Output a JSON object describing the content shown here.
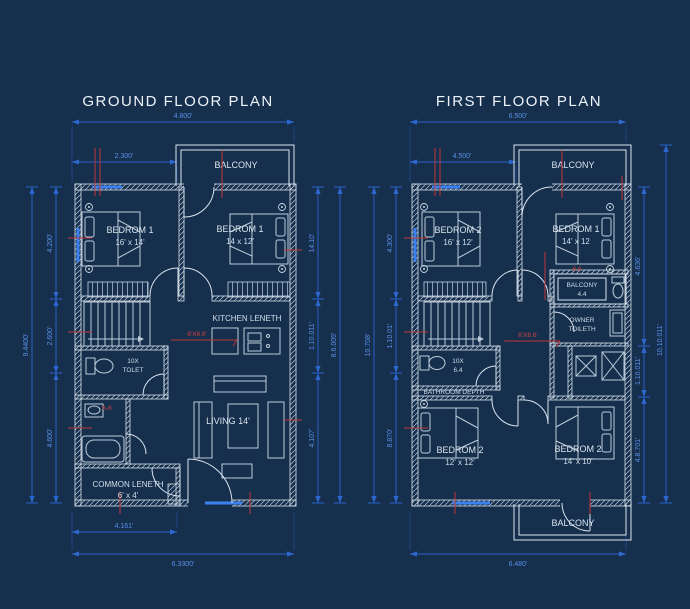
{
  "colors": {
    "background": "#152f4d",
    "wall_line": "#d8e1eb",
    "dimension_blue": "#2d66cf",
    "dimension_text_blue": "#5b8fe8",
    "window_blue": "#3b82f0",
    "annotation_red": "#c03636",
    "label_white": "#dbe5ef"
  },
  "icons": [
    "stairs-icon",
    "bed-icon",
    "wardrobe-icon",
    "kitchen-counter-icon",
    "sink-icon",
    "toilet-icon",
    "bathtub-icon",
    "washbasin-icon",
    "sofa-icon",
    "table-icon",
    "tv-unit-icon",
    "door-arc-icon",
    "window-marker-icon",
    "ceiling-point-icon",
    "shower-icon"
  ],
  "ground": {
    "title": "GROUND FLOOR PLAN",
    "dims": {
      "top_overall": "4.800'",
      "top_left": "2.300'",
      "bottom_left": "4.161'",
      "bottom_overall": "6.3300'",
      "left_seg1": "4.200'",
      "left_seg2": "2.600'",
      "left_seg3": "4.600'",
      "left_overall": "9.4400'",
      "right_seg1": "14.10'",
      "right_seg2": "1.10.011'",
      "right_seg3": "4.107'",
      "right_overall": "8.6.005'"
    },
    "labels": {
      "balcony": "BALCONY",
      "bed_tl_name": "BEDROM 1",
      "bed_tl_size": "16' x 14'",
      "bed_tr_name": "BEDROM 1",
      "bed_tr_size": "14 x 12'",
      "kitchen": "KITCHEN LENETH",
      "toilet_l1": "10X",
      "toilet_l2": "TOLET",
      "living": "LIVING 14'",
      "common_l1": "COMMON LENETH",
      "common_l2": "6' x 4'",
      "red_kitchen": "6'X6.6'",
      "red_toilet": "6-6"
    }
  },
  "first": {
    "title": "FIRST FLOOR PLAN",
    "dims": {
      "top_overall": "6.500'",
      "top_left": "4.500'",
      "bottom_overall": "6.480'",
      "left_seg1": "4.300'",
      "left_seg2": "1.10.01'",
      "left_seg3": "8.870'",
      "left_overall": "10.708'",
      "right_seg1": "4.636'",
      "right_seg2": "1.10.011'",
      "right_seg3": "4.8.701'",
      "right_overall": "10.10.011'"
    },
    "labels": {
      "balcony_top": "BALCONY",
      "balcony_bottom": "BALCONY",
      "bed_tl_name": "BEDROM 2",
      "bed_tl_size": "16' x 12'",
      "bed_tr_name": "BEDROM 1",
      "bed_tr_size": "14' x 12",
      "small_balcony_l1": "BALCONY",
      "small_balcony_l2": "4.4",
      "owner_toilet_l1": "OWNER",
      "owner_toilet_l2": "TOILETH",
      "toilet_l1": "10X",
      "toilet_l2": "6.4",
      "bathroom": "BATHROOM DEPTH",
      "bed_bl_name": "BEDROM 2",
      "bed_bl_size": "12' x 12'",
      "bed_br_name": "BEDROM 2",
      "bed_br_size": "14' x 10'",
      "red_center": "6'X6.6'",
      "red_balcony": "6.6"
    }
  }
}
